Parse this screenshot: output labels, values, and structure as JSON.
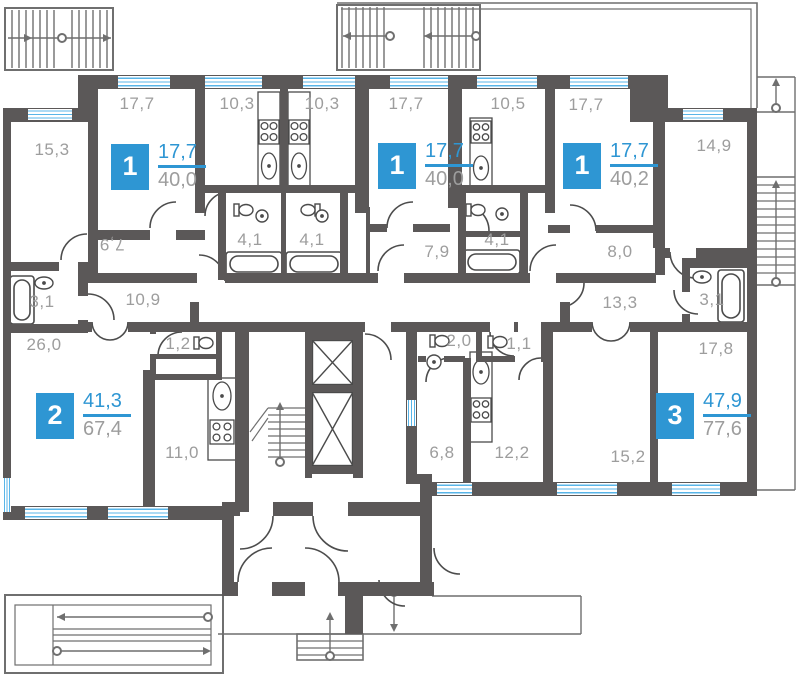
{
  "title": "apartment-floor-plan",
  "colors": {
    "wall": "#5b5858",
    "accent_blue": "#2e96d3",
    "window_blue": "#58b5e8",
    "label_gray": "#9d9d9d",
    "linework": "#6f6f6f"
  },
  "rooms": [
    {
      "label": "15,3",
      "x": 52,
      "y": 150,
      "rot": 0
    },
    {
      "label": "17,7",
      "x": 137,
      "y": 104,
      "rot": 0
    },
    {
      "label": "10,3",
      "x": 237,
      "y": 104,
      "rot": 0
    },
    {
      "label": "10,3",
      "x": 322,
      "y": 104,
      "rot": 0
    },
    {
      "label": "17,7",
      "x": 406,
      "y": 104,
      "rot": 0
    },
    {
      "label": "10,5",
      "x": 508,
      "y": 104,
      "rot": 0
    },
    {
      "label": "17,7",
      "x": 586,
      "y": 105,
      "rot": 0
    },
    {
      "label": "14,9",
      "x": 714,
      "y": 146,
      "rot": 0
    },
    {
      "label": "7,9",
      "x": 112,
      "y": 244,
      "rot": 180
    },
    {
      "label": "4,1",
      "x": 250,
      "y": 240,
      "rot": 0
    },
    {
      "label": "4,1",
      "x": 312,
      "y": 240,
      "rot": 0
    },
    {
      "label": "4,1",
      "x": 497,
      "y": 240,
      "rot": 0
    },
    {
      "label": "7,9",
      "x": 437,
      "y": 252,
      "rot": 0
    },
    {
      "label": "8,0",
      "x": 620,
      "y": 252,
      "rot": 0
    },
    {
      "label": "10,9",
      "x": 143,
      "y": 300,
      "rot": 0
    },
    {
      "label": "13,3",
      "x": 620,
      "y": 303,
      "rot": 0
    },
    {
      "label": "3,1",
      "x": 42,
      "y": 302,
      "rot": 0
    },
    {
      "label": "3,1",
      "x": 712,
      "y": 300,
      "rot": 0
    },
    {
      "label": "26,0",
      "x": 44,
      "y": 345,
      "rot": 0
    },
    {
      "label": "1,2",
      "x": 178,
      "y": 344,
      "rot": 0
    },
    {
      "label": "2,0",
      "x": 459,
      "y": 341,
      "rot": 0
    },
    {
      "label": "1,1",
      "x": 519,
      "y": 344,
      "rot": 0
    },
    {
      "label": "17,8",
      "x": 716,
      "y": 349,
      "rot": 0
    },
    {
      "label": "11,0",
      "x": 182,
      "y": 453,
      "rot": 0
    },
    {
      "label": "6,8",
      "x": 442,
      "y": 453,
      "rot": 0
    },
    {
      "label": "12,2",
      "x": 512,
      "y": 453,
      "rot": 0
    },
    {
      "label": "15,2",
      "x": 628,
      "y": 457,
      "rot": 0
    }
  ],
  "apartments": [
    {
      "number": "1",
      "living": "17,7",
      "total": "40,0",
      "x": 111,
      "y": 142
    },
    {
      "number": "1",
      "living": "17,7",
      "total": "40,0",
      "x": 378,
      "y": 141
    },
    {
      "number": "1",
      "living": "17,7",
      "total": "40,2",
      "x": 563,
      "y": 141
    },
    {
      "number": "2",
      "living": "41,3",
      "total": "67,4",
      "x": 36,
      "y": 391
    },
    {
      "number": "3",
      "living": "47,9",
      "total": "77,6",
      "x": 656,
      "y": 391
    }
  ],
  "icons": [
    "window",
    "door-arc",
    "bathtub-icon",
    "toilet-icon",
    "sink-icon",
    "stove-icon",
    "elevator-icon",
    "stairs-icon",
    "direction-arrow-icon"
  ]
}
